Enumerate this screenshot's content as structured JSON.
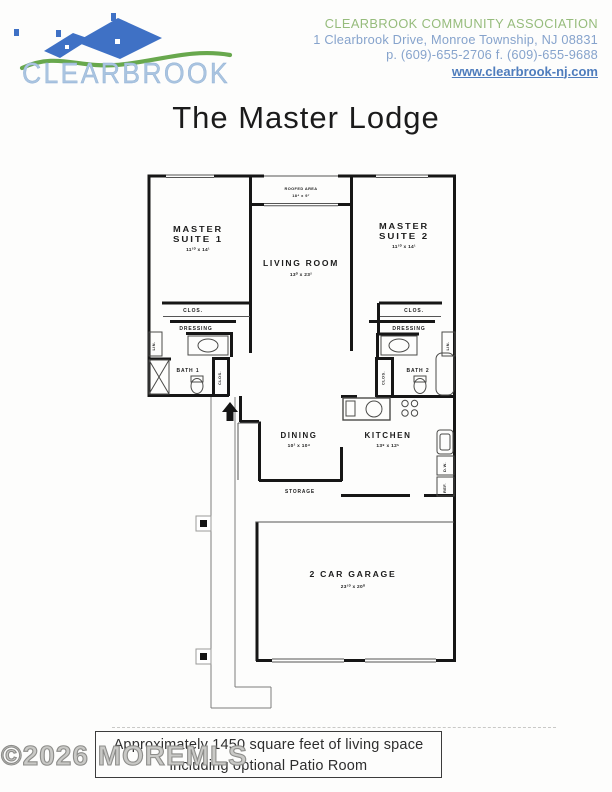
{
  "header": {
    "logo_text": "CLEARBROOK",
    "org_name": "CLEARBROOK COMMUNITY ASSOCIATION",
    "address": "1 Clearbrook Drive, Monroe Township, NJ 08831",
    "phone_fax": "p. (609)-655-2706 f. (609)-655-9688",
    "website": "www.clearbrook-nj.com"
  },
  "title": "The Master Lodge",
  "floorplan": {
    "roofed_area": {
      "label": "ROOFED AREA",
      "dims": "18⁴ x 9⁷"
    },
    "master_suite_1": {
      "line1": "MASTER",
      "line2": "SUITE 1",
      "dims": "11¹⁰ x 14¹"
    },
    "master_suite_2": {
      "line1": "MASTER",
      "line2": "SUITE 2",
      "dims": "11¹⁰ x 14¹"
    },
    "living_room": {
      "label": "LIVING ROOM",
      "dims": "13⁰ x 23²"
    },
    "dining": {
      "label": "DINING",
      "dims": "10² x 10⁴"
    },
    "kitchen": {
      "label": "KITCHEN",
      "dims": "13⁸ x 12⁵"
    },
    "garage": {
      "label": "2 CAR GARAGE",
      "dims": "23¹⁰ x 20⁰"
    },
    "storage_label": "STORAGE",
    "closet_label": "CLOS.",
    "dressing_label": "DRESSING",
    "linen_label": "LIN.",
    "bath1_label": "BATH 1",
    "bath2_label": "BATH 2",
    "dw_label": "D.W.",
    "ref_label": "REF."
  },
  "footer": {
    "watermark": "©2026 MOREMLS",
    "note_line1": "Approximately 1450 square feet of living space",
    "note_line2": "including optional Patio Room"
  },
  "colors": {
    "org_green": "#96bc7c",
    "info_blue": "#86a3cc",
    "link_blue": "#4f7dbd",
    "logo_text_blue": "#aac4e0",
    "roof_blue": "#3f71c5",
    "swoosh_green": "#68a84d",
    "wall_black": "#161616"
  }
}
